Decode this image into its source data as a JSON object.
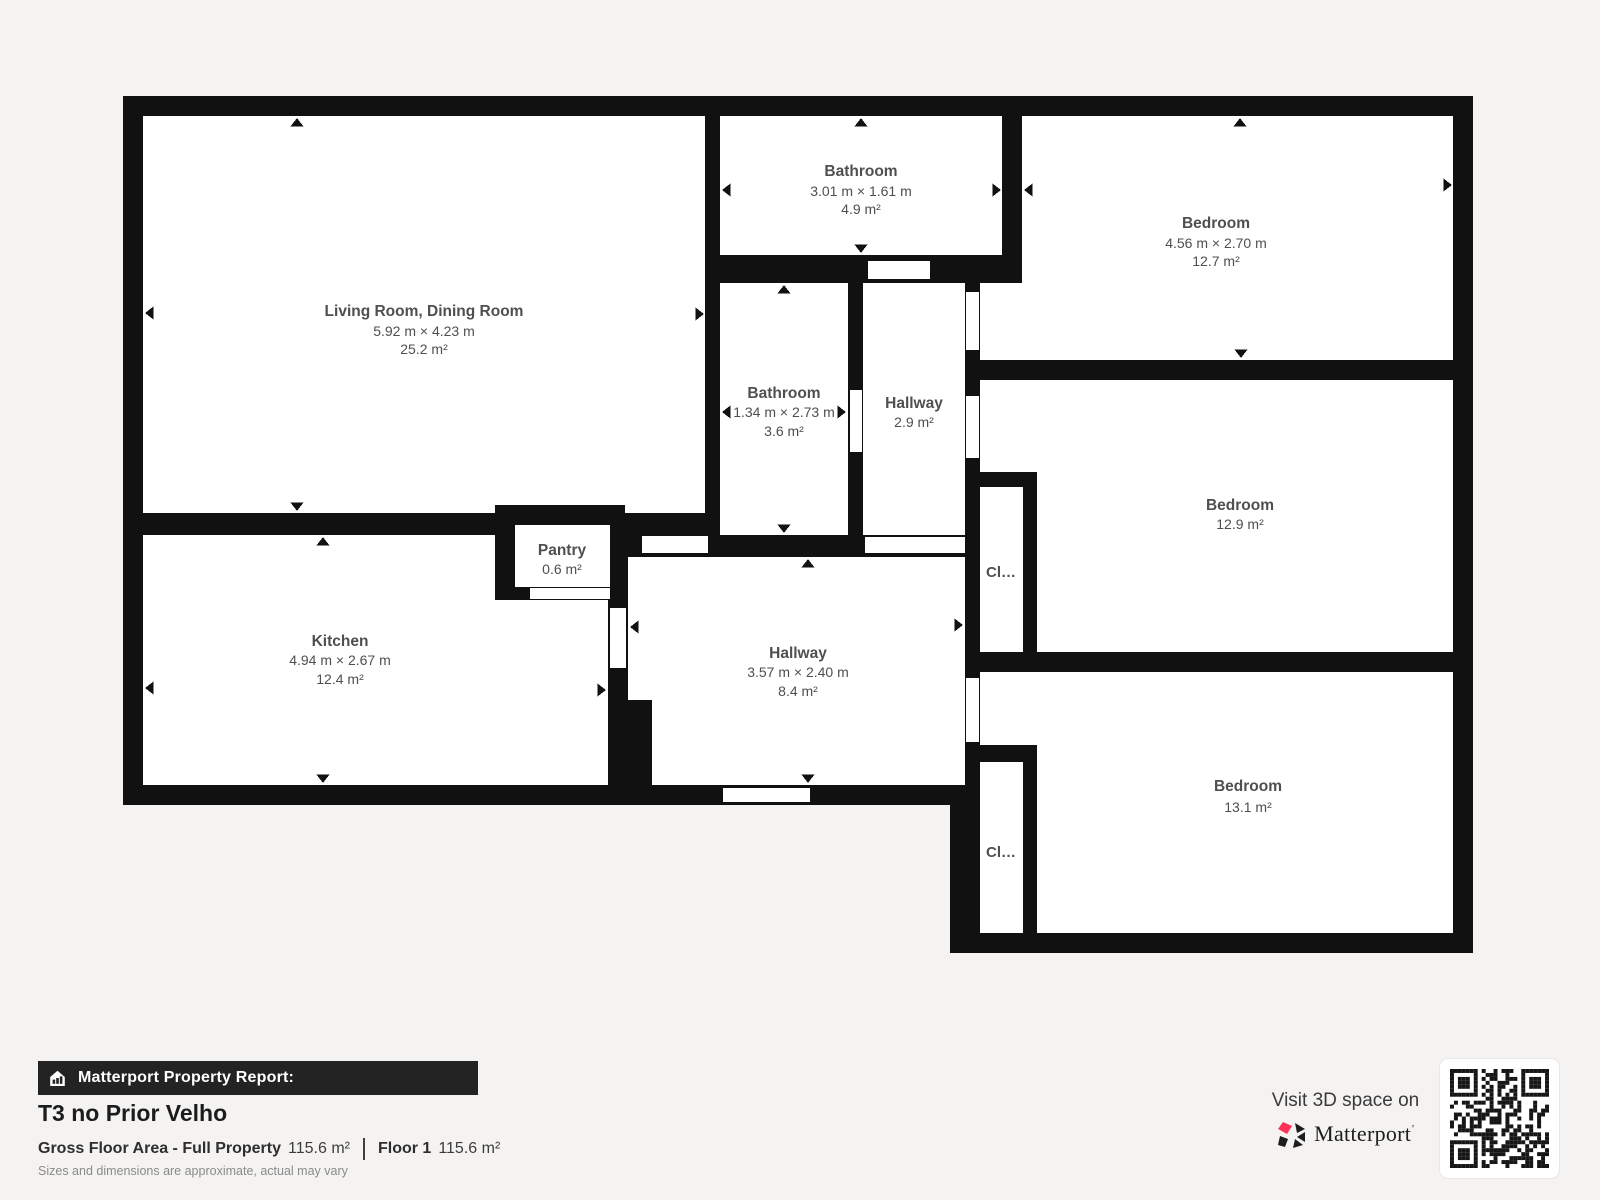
{
  "floorplan": {
    "rooms": [
      {
        "id": "living-dining",
        "name": "Living Room, Dining Room",
        "dims": "5.92 m × 4.23 m",
        "area": "25.2 m²"
      },
      {
        "id": "bathroom-top",
        "name": "Bathroom",
        "dims": "3.01 m × 1.61 m",
        "area": "4.9 m²"
      },
      {
        "id": "bedroom-1",
        "name": "Bedroom",
        "dims": "4.56 m × 2.70 m",
        "area": "12.7 m²"
      },
      {
        "id": "bathroom-mid",
        "name": "Bathroom",
        "dims": "1.34 m × 2.73 m",
        "area": "3.6 m²"
      },
      {
        "id": "hallway-small",
        "name": "Hallway",
        "area": "2.9 m²"
      },
      {
        "id": "bedroom-2",
        "name": "Bedroom",
        "area": "12.9 m²"
      },
      {
        "id": "pantry",
        "name": "Pantry",
        "area": "0.6 m²"
      },
      {
        "id": "kitchen",
        "name": "Kitchen",
        "dims": "4.94 m × 2.67 m",
        "area": "12.4 m²"
      },
      {
        "id": "hallway-main",
        "name": "Hallway",
        "dims": "3.57 m × 2.40 m",
        "area": "8.4 m²"
      },
      {
        "id": "bedroom-3",
        "name": "Bedroom",
        "area": "13.1 m²"
      },
      {
        "id": "closet-1",
        "name": "Cl…"
      },
      {
        "id": "closet-2",
        "name": "Cl…"
      }
    ]
  },
  "footer": {
    "banner_label": "Matterport Property Report:",
    "property_title": "T3 no Prior Velho",
    "area": {
      "gross_label": "Gross Floor Area - Full Property",
      "gross_value": "115.6 m²",
      "floor_label": "Floor 1",
      "floor_value": "115.6 m²"
    },
    "disclaimer": "Sizes and dimensions are approximate, actual may vary",
    "cta_text": "Visit 3D space on",
    "brand": "Matterport",
    "trademark": "’"
  },
  "icons": {
    "banner": "house-bar-chart-icon",
    "logo": "matterport-pinwheel-icon",
    "qr": "qr-code"
  },
  "colors": {
    "wall": "#111111",
    "room_fill": "#ffffff",
    "background": "#f4f3f1",
    "label_text": "#4f4f4f",
    "banner_bg": "#232323",
    "accent_red": "#ff3158"
  }
}
